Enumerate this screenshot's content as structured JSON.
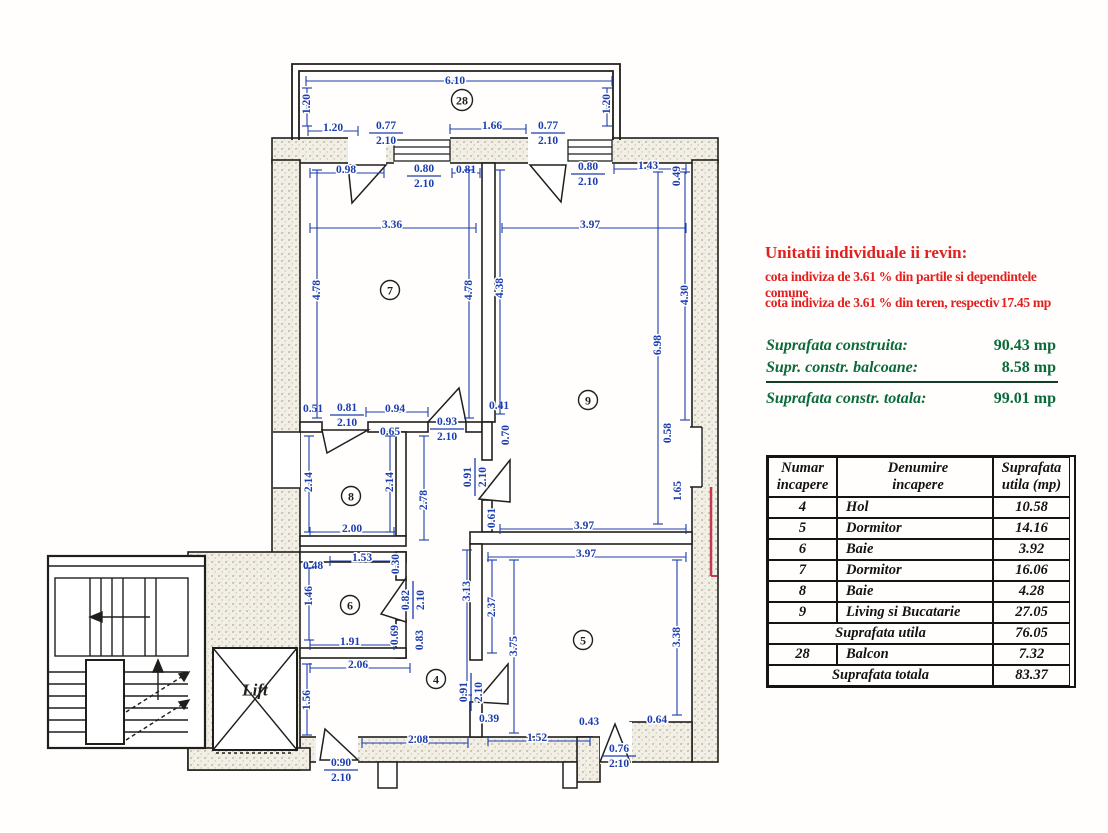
{
  "annotations": {
    "title_red": "Unitatii individuale ii revin:",
    "red_line1": "cota indiviza de  3.61 %  din partile si dependintele comune",
    "red_line2_label": "cota indiviza de  3.61 %  din teren, respectiv",
    "red_line2_value": "17.45  mp",
    "green_rows": [
      {
        "label": "Suprafata construita:",
        "value": "90.43 mp"
      },
      {
        "label": "Supr. constr. balcoane:",
        "value": "8.58 mp"
      }
    ],
    "green_total": {
      "label": "Suprafata constr. totala:",
      "value": "99.01 mp"
    }
  },
  "table": {
    "headers": [
      [
        "Numar",
        "incapere"
      ],
      [
        "Denumire",
        "incapere"
      ],
      [
        "Suprafata",
        "utila (mp)"
      ]
    ],
    "rows": [
      {
        "num": "4",
        "name": "Hol",
        "area": "10.58"
      },
      {
        "num": "5",
        "name": "Dormitor",
        "area": "14.16"
      },
      {
        "num": "6",
        "name": "Baie",
        "area": "3.92"
      },
      {
        "num": "7",
        "name": "Dormitor",
        "area": "16.06"
      },
      {
        "num": "8",
        "name": "Baie",
        "area": "4.28"
      },
      {
        "num": "9",
        "name": "Living si Bucatarie",
        "area": "27.05"
      }
    ],
    "subtotal": {
      "label": "Suprafata utila",
      "value": "76.05"
    },
    "balcony_row": {
      "num": "28",
      "name": "Balcon",
      "area": "7.32"
    },
    "total": {
      "label": "Suprafata totala",
      "value": "83.37"
    }
  },
  "floorplan": {
    "lift_label": "Lift",
    "rooms": [
      {
        "n": "28",
        "x": 462,
        "y": 100
      },
      {
        "n": "7",
        "x": 390,
        "y": 290
      },
      {
        "n": "9",
        "x": 588,
        "y": 400
      },
      {
        "n": "8",
        "x": 351,
        "y": 496
      },
      {
        "n": "6",
        "x": 350,
        "y": 605
      },
      {
        "n": "4",
        "x": 436,
        "y": 679
      },
      {
        "n": "5",
        "x": 583,
        "y": 640
      }
    ],
    "dims": [
      {
        "t": "6.10",
        "x": 455,
        "y": 81,
        "line": [
          306,
          81,
          612,
          81
        ]
      },
      {
        "t": "1.20",
        "x": 333,
        "y": 128,
        "line": [
          308,
          131,
          358,
          131
        ]
      },
      {
        "t": "1.66",
        "x": 492,
        "y": 126,
        "line": [
          450,
          129,
          526,
          129
        ]
      },
      {
        "t": "0.98",
        "x": 346,
        "y": 170,
        "line": [
          310,
          173,
          384,
          173
        ]
      },
      {
        "t": "0.81",
        "x": 466,
        "y": 170,
        "line": [
          452,
          173,
          480,
          173
        ]
      },
      {
        "t": "1.43",
        "x": 648,
        "y": 166,
        "line": [
          614,
          169,
          686,
          169
        ]
      },
      {
        "t": "3.36",
        "x": 392,
        "y": 225,
        "line": [
          310,
          228,
          476,
          228
        ]
      },
      {
        "t": "3.97",
        "x": 590,
        "y": 225,
        "line": [
          502,
          228,
          686,
          228
        ]
      },
      {
        "t": "0.51",
        "x": 313,
        "y": 409
      },
      {
        "t": "0.94",
        "x": 395,
        "y": 409,
        "line": [
          366,
          412,
          428,
          412
        ]
      },
      {
        "t": "0.41",
        "x": 499,
        "y": 406
      },
      {
        "t": "0.65",
        "x": 390,
        "y": 432
      },
      {
        "t": "2.00",
        "x": 352,
        "y": 529,
        "line": [
          310,
          532,
          394,
          532
        ]
      },
      {
        "t": "3.97",
        "x": 584,
        "y": 526,
        "line": [
          500,
          529,
          686,
          529
        ]
      },
      {
        "t": "3.97",
        "x": 586,
        "y": 554,
        "line": [
          488,
          557,
          686,
          557
        ]
      },
      {
        "t": "1.53",
        "x": 362,
        "y": 558,
        "line": [
          330,
          561,
          394,
          561
        ]
      },
      {
        "t": "0.48",
        "x": 313,
        "y": 566
      },
      {
        "t": "1.91",
        "x": 350,
        "y": 642,
        "line": [
          310,
          645,
          394,
          645
        ]
      },
      {
        "t": "2.06",
        "x": 358,
        "y": 665,
        "line": [
          310,
          668,
          410,
          668
        ]
      },
      {
        "t": "0.39",
        "x": 489,
        "y": 719
      },
      {
        "t": "2.08",
        "x": 418,
        "y": 740,
        "line": [
          362,
          743,
          468,
          743
        ]
      },
      {
        "t": "1.52",
        "x": 537,
        "y": 738,
        "line": [
          488,
          741,
          590,
          741
        ]
      },
      {
        "t": "0.43",
        "x": 589,
        "y": 722
      },
      {
        "t": "0.64",
        "x": 657,
        "y": 720
      },
      {
        "t": "1.20",
        "x": 307,
        "y": 104,
        "r": 1,
        "line": [
          307,
          88,
          307,
          126
        ]
      },
      {
        "t": "1.20",
        "x": 607,
        "y": 104,
        "r": 1,
        "line": [
          607,
          88,
          607,
          126
        ]
      },
      {
        "t": "0.49",
        "x": 677,
        "y": 176,
        "r": 1
      },
      {
        "t": "4.78",
        "x": 317,
        "y": 290,
        "r": 1,
        "line": [
          317,
          170,
          317,
          418
        ]
      },
      {
        "t": "4.78",
        "x": 469,
        "y": 290,
        "r": 1,
        "line": [
          469,
          170,
          469,
          418
        ]
      },
      {
        "t": "4.38",
        "x": 500,
        "y": 288,
        "r": 1,
        "line": [
          500,
          170,
          500,
          414
        ]
      },
      {
        "t": "4.30",
        "x": 685,
        "y": 295,
        "r": 1,
        "line": [
          685,
          172,
          685,
          420
        ]
      },
      {
        "t": "6.98",
        "x": 658,
        "y": 345,
        "r": 1,
        "line": [
          658,
          172,
          658,
          524
        ]
      },
      {
        "t": "0.58",
        "x": 668,
        "y": 433,
        "r": 1
      },
      {
        "t": "1.65",
        "x": 678,
        "y": 491,
        "r": 1
      },
      {
        "t": "0.70",
        "x": 506,
        "y": 435,
        "r": 1
      },
      {
        "t": "2.14",
        "x": 309,
        "y": 482,
        "r": 1,
        "line": [
          309,
          436,
          309,
          532
        ]
      },
      {
        "t": "2.14",
        "x": 390,
        "y": 482,
        "r": 1,
        "line": [
          390,
          436,
          390,
          532
        ]
      },
      {
        "t": "2.78",
        "x": 424,
        "y": 500,
        "r": 1,
        "line": [
          424,
          436,
          424,
          540
        ]
      },
      {
        "t": "0.61",
        "x": 492,
        "y": 518,
        "r": 1
      },
      {
        "t": "0.30",
        "x": 396,
        "y": 564,
        "r": 1
      },
      {
        "t": "1.46",
        "x": 309,
        "y": 596,
        "r": 1,
        "line": [
          309,
          568,
          309,
          640
        ]
      },
      {
        "t": "0.69",
        "x": 395,
        "y": 635,
        "r": 1
      },
      {
        "t": "0.83",
        "x": 420,
        "y": 640,
        "r": 1
      },
      {
        "t": "3.13",
        "x": 467,
        "y": 591,
        "r": 1,
        "line": [
          467,
          550,
          467,
          695
        ]
      },
      {
        "t": "2.37",
        "x": 492,
        "y": 607,
        "r": 1,
        "line": [
          492,
          560,
          492,
          653
        ]
      },
      {
        "t": "3.75",
        "x": 514,
        "y": 646,
        "r": 1,
        "line": [
          514,
          560,
          514,
          733
        ]
      },
      {
        "t": "3.38",
        "x": 677,
        "y": 637,
        "r": 1,
        "line": [
          677,
          560,
          677,
          715
        ]
      },
      {
        "t": "1.56",
        "x": 307,
        "y": 700,
        "r": 1,
        "line": [
          307,
          664,
          307,
          735
        ]
      }
    ],
    "fracs": [
      {
        "top": "0.77",
        "bot": "2.10",
        "x": 386,
        "y": 133
      },
      {
        "top": "0.77",
        "bot": "2.10",
        "x": 548,
        "y": 133
      },
      {
        "top": "0.80",
        "bot": "2.10",
        "x": 424,
        "y": 176
      },
      {
        "top": "0.80",
        "bot": "2.10",
        "x": 588,
        "y": 174
      },
      {
        "top": "0.81",
        "bot": "2.10",
        "x": 347,
        "y": 415
      },
      {
        "top": "0.93",
        "bot": "2.10",
        "x": 447,
        "y": 429
      },
      {
        "top": "0.90",
        "bot": "2.10",
        "x": 341,
        "y": 770
      },
      {
        "top": "0.76",
        "bot": "2.10",
        "x": 619,
        "y": 756
      }
    ],
    "vfracs": [
      {
        "top": "0.91",
        "bot": "2.10",
        "x": 475,
        "y": 477
      },
      {
        "top": "0.82",
        "bot": "2.10",
        "x": 413,
        "y": 600
      },
      {
        "top": "0.91",
        "bot": "2.10",
        "x": 471,
        "y": 692
      }
    ],
    "colors": {
      "dim_blue": "#1c3dad",
      "wall_ink": "#211f1c",
      "red_text": "#e02120",
      "green_text": "#0b6a3a",
      "boundary_red": "#c23b4e"
    }
  }
}
